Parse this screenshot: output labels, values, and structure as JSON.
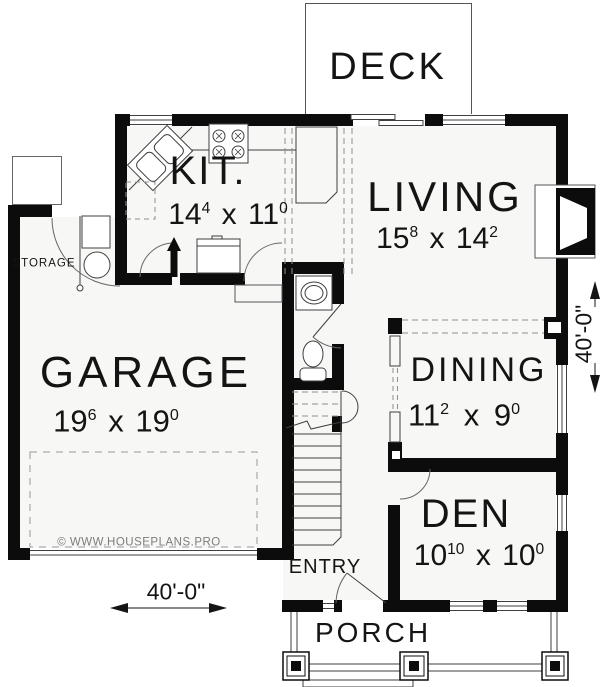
{
  "colors": {
    "wall": "#0c0c0c",
    "thin_line": "#3f3f3f",
    "dashed_line": "#8f8f8f",
    "floor": "#f7f7f6",
    "text": "#141414",
    "watermark": "#7d7d7d"
  },
  "rooms": {
    "deck": {
      "label": "DECK"
    },
    "kitchen": {
      "label": "KIT.",
      "dim": {
        "a": "14",
        "a_sup": "4",
        "sep": "x",
        "b": "11",
        "b_sup": "0"
      }
    },
    "living": {
      "label": "LIVING",
      "dim": {
        "a": "15",
        "a_sup": "8",
        "sep": "x",
        "b": "14",
        "b_sup": "2"
      }
    },
    "garage": {
      "label": "GARAGE",
      "dim": {
        "a": "19",
        "a_sup": "6",
        "sep": "x",
        "b": "19",
        "b_sup": "0"
      }
    },
    "dining": {
      "label": "DINING",
      "dim": {
        "a": "11",
        "a_sup": "2",
        "sep": "x",
        "b": "9",
        "b_sup": "0"
      }
    },
    "den": {
      "label": "DEN",
      "dim": {
        "a": "10",
        "a_sup": "10",
        "sep": "x",
        "b": "10",
        "b_sup": "0"
      }
    },
    "storage": {
      "label": "STORAGE"
    },
    "entry": {
      "label": "ENTRY"
    },
    "porch": {
      "label": "PORCH"
    }
  },
  "dimensions": {
    "overall_width": "40'-0\"",
    "overall_depth": "40'-0\""
  },
  "watermark": "© WWW.HOUSEPLANS.PRO",
  "symbols": {
    "corner_sink": "corner-sink",
    "range": "range-4-burner",
    "refrigerator": "refrigerator",
    "island": "kitchen-island",
    "water_heater": "water-heater",
    "utility_unit": "utility-unit",
    "vanity": "vanity-sink",
    "toilet": "toilet",
    "fireplace": "fireplace",
    "stairs": "staircase",
    "garage_door": "overhead-garage-door",
    "porch_columns": "porch-columns",
    "front_door": "front-door-swing"
  }
}
